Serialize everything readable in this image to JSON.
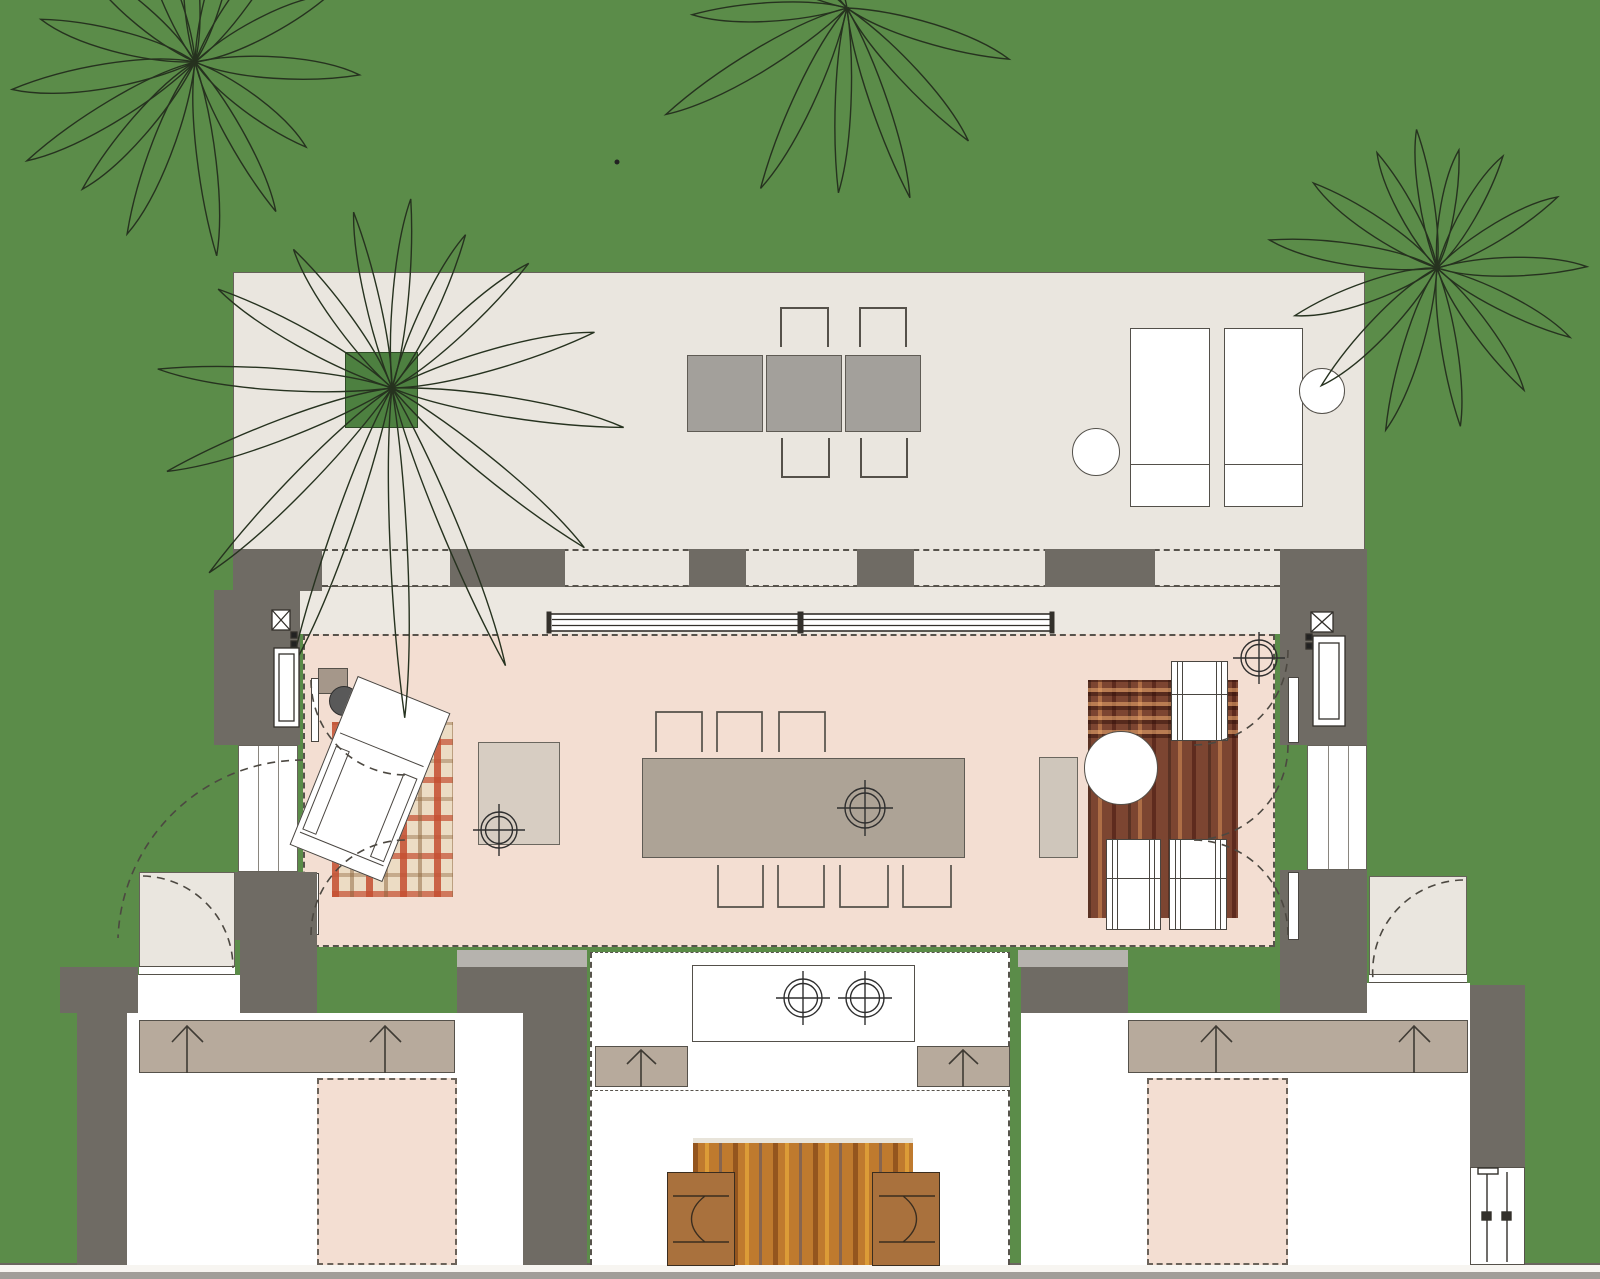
{
  "meta": {
    "type": "architectural-floor-plan",
    "view": "site / ground floor plan",
    "canvas": {
      "width": 1600,
      "height": 1279
    }
  },
  "palette": {
    "lawn": "#5b8c49",
    "paving": "#eae6df",
    "porch": "#ece8e1",
    "wall_dark": "#6f6b64",
    "wall_light": "#b6b3ae",
    "floor_pink": "#f3ded2",
    "outdoor_table_gray": "#a3a09b",
    "dining_table": "#ada396",
    "millwork_tan": "#b7aa9c",
    "side_table": "#a5978a",
    "bench": "#cfc6bb",
    "stool": "#595959",
    "armchair_brown": "#a9713d",
    "rug_kilim": "#7c4531",
    "rug_runner_orange": "#bf7a2e",
    "rug_plaid_base": "#ecdcc4",
    "planter_green": "#4d8040",
    "line": "#3c3832",
    "palm_stroke": "#26321f"
  },
  "rooms": [
    {
      "id": "terrace",
      "label": "outdoor terrace",
      "furniture": [
        "planter tree",
        "outdoor dining table (3 modules)",
        "4 outdoor chairs",
        "2 sun loungers",
        "2 round side tables"
      ]
    },
    {
      "id": "veranda",
      "label": "veranda with sliding glass wall and column row"
    },
    {
      "id": "living-pavilion",
      "label": "living / dining pavilion",
      "furniture": [
        "rotated chaise lounge chair",
        "plaid rug",
        "square coffee table",
        "8-seat dining table",
        "kilim rug",
        "round table",
        "3 white armchairs",
        "bench",
        "3 ceiling fans"
      ]
    },
    {
      "id": "bedroom-west",
      "label": "west bedroom",
      "furniture": [
        "wardrobe with 2 door arrows",
        "double bed (dashed)"
      ]
    },
    {
      "id": "kitchen-court",
      "label": "central kitchen court",
      "furniture": [
        "island with 2 burners",
        "2 base cabinets",
        "striped runner rug",
        "2 brown armchairs"
      ]
    },
    {
      "id": "bedroom-east",
      "label": "east bedroom",
      "furniture": [
        "wardrobe with 2 door arrows",
        "double bed (dashed)",
        "sliding louver door"
      ]
    },
    {
      "id": "patio-west",
      "label": "west entry patio with door swing"
    },
    {
      "id": "patio-east",
      "label": "east entry patio with door swing"
    }
  ],
  "site": {
    "ground": "lawn",
    "dot": {
      "x": 617,
      "y": 162
    },
    "palms": [
      {
        "id": "palm-top-left",
        "cx": 195,
        "cy": 62,
        "leaves": [
          [
            150,
            195,
            15
          ],
          [
            172,
            185,
            17
          ],
          [
            196,
            160,
            15
          ],
          [
            222,
            150,
            14
          ],
          [
            250,
            165,
            13
          ],
          [
            268,
            140,
            11
          ],
          [
            287,
            150,
            12
          ],
          [
            307,
            160,
            13
          ],
          [
            334,
            150,
            14
          ],
          [
            5,
            165,
            15
          ],
          [
            38,
            140,
            13
          ],
          [
            62,
            170,
            12
          ],
          [
            84,
            195,
            13
          ],
          [
            112,
            185,
            15
          ],
          [
            132,
            170,
            14
          ]
        ]
      },
      {
        "id": "palm-top-center",
        "cx": 847,
        "cy": 8,
        "leaves": [
          [
            18,
            170,
            14
          ],
          [
            48,
            180,
            13
          ],
          [
            72,
            200,
            12
          ],
          [
            93,
            185,
            11
          ],
          [
            116,
            200,
            14
          ],
          [
            150,
            210,
            16
          ],
          [
            178,
            155,
            13
          ],
          [
            208,
            140,
            12
          ],
          [
            243,
            120,
            10
          ]
        ]
      },
      {
        "id": "palm-right",
        "cx": 1437,
        "cy": 268,
        "leaves": [
          [
            0,
            150,
            13
          ],
          [
            28,
            150,
            12
          ],
          [
            55,
            150,
            12
          ],
          [
            82,
            160,
            11
          ],
          [
            108,
            170,
            13
          ],
          [
            135,
            165,
            14
          ],
          [
            162,
            150,
            14
          ],
          [
            190,
            170,
            15
          ],
          [
            215,
            150,
            13
          ],
          [
            243,
            130,
            11
          ],
          [
            262,
            140,
            10
          ],
          [
            281,
            120,
            10
          ],
          [
            301,
            130,
            11
          ],
          [
            330,
            140,
            12
          ]
        ]
      },
      {
        "id": "palm-planter",
        "cx": 392,
        "cy": 388,
        "leaves": [
          [
            160,
            240,
            14
          ],
          [
            185,
            235,
            15
          ],
          [
            210,
            200,
            13
          ],
          [
            235,
            170,
            12
          ],
          [
            258,
            180,
            10
          ],
          [
            276,
            190,
            11
          ],
          [
            296,
            170,
            11
          ],
          [
            318,
            185,
            12
          ],
          [
            345,
            210,
            14
          ],
          [
            10,
            235,
            14
          ],
          [
            40,
            250,
            13
          ],
          [
            68,
            300,
            12
          ],
          [
            88,
            330,
            12
          ],
          [
            110,
            300,
            13
          ],
          [
            135,
            260,
            13
          ]
        ]
      }
    ]
  }
}
